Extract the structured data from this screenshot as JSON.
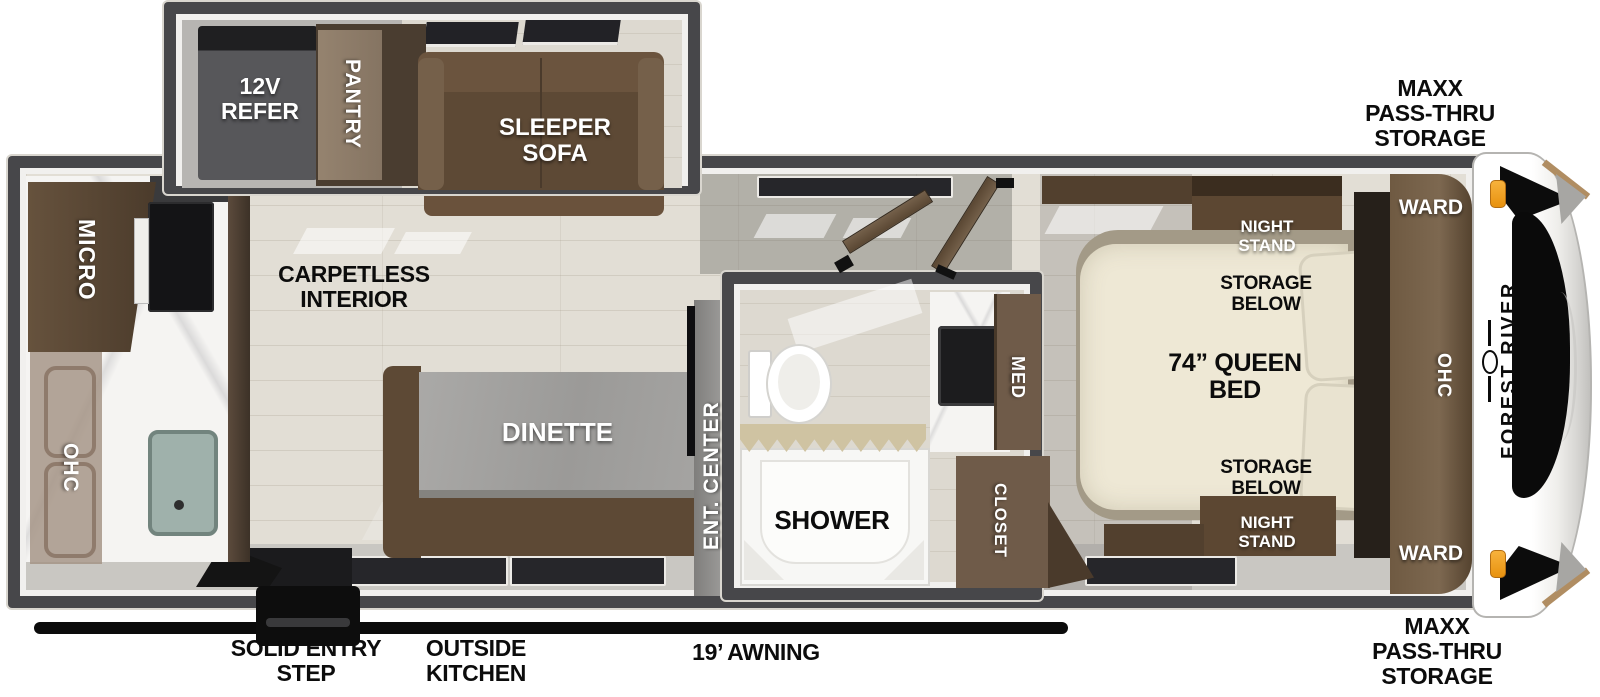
{
  "slideout": {
    "refer_label": "12V\nREFER",
    "pantry_label": "PANTRY",
    "sofa_label": "SLEEPER\nSOFA"
  },
  "kitchen": {
    "micro_label": "MICRO",
    "ohc_label": "OHC"
  },
  "living": {
    "floor_label": "CARPETLESS\nINTERIOR",
    "dinette_label": "DINETTE",
    "ent_center_label": "ENT. CENTER"
  },
  "bathroom": {
    "shower_label": "SHOWER",
    "med_label": "MED"
  },
  "bedroom": {
    "closet_label": "CLOSET",
    "bed_label": "74” QUEEN\nBED",
    "storage_top_label": "STORAGE\nBELOW",
    "storage_bottom_label": "STORAGE\nBELOW",
    "nightstand_top_label": "NIGHT\nSTAND",
    "nightstand_bottom_label": "NIGHT\nSTAND",
    "ward_top_label": "WARD",
    "ward_bottom_label": "WARD",
    "ohc_label": "OHC"
  },
  "exterior": {
    "brand_label": "FOREST RIVER",
    "storage_top_label": "MAXX\nPASS-THRU\nSTORAGE",
    "storage_bottom_label": "MAXX\nPASS-THRU\nSTORAGE",
    "entry_step_label": "SOLID ENTRY\nSTEP",
    "outside_kitchen_label": "OUTSIDE\nKITCHEN",
    "awning_label": "19’ AWNING"
  },
  "colors": {
    "wall_gray": "#47474a",
    "trim_white": "#f1f0ee",
    "floor_wood": "#e2ded5",
    "furniture_brown": "#5d4935",
    "cabinet_dark_brown": "#52402e",
    "mattress_cream": "#eee8d5",
    "marker_orange": "#f5a725",
    "awning_black": "#0b0b0b"
  }
}
